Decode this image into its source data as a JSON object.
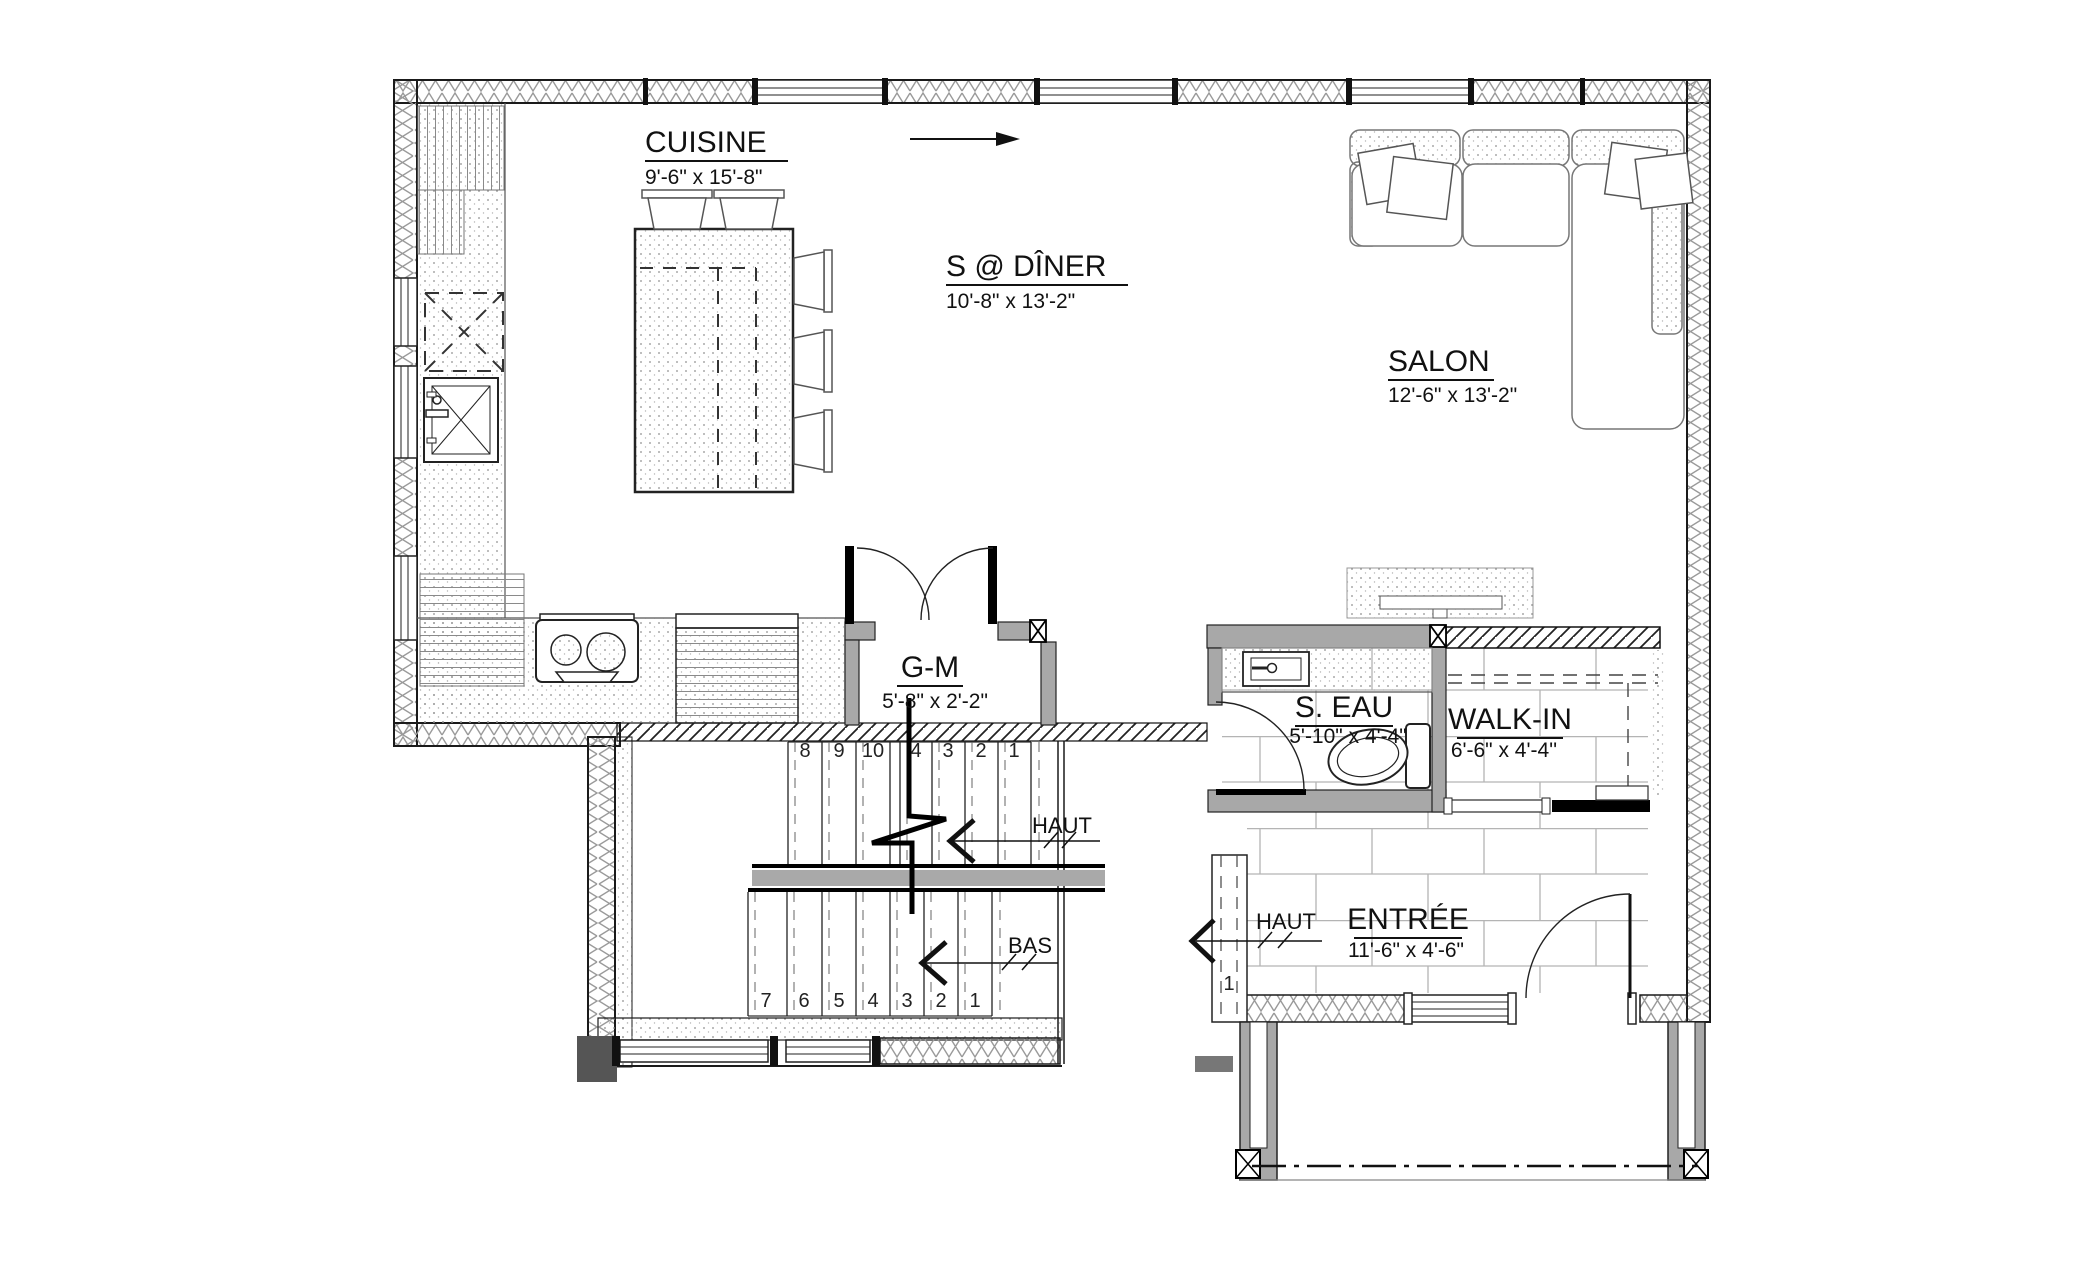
{
  "rooms": {
    "cuisine": {
      "name": "CUISINE",
      "dims": "9'-6\" x 15'-8\""
    },
    "salle_a_diner": {
      "name": "S @ DÎNER",
      "dims": "10'-8\" x 13'-2\""
    },
    "salon": {
      "name": "SALON",
      "dims": "12'-6\" x 13'-2\""
    },
    "garde_manger": {
      "name": "G-M",
      "dims": "5'-8\" x 2'-2\""
    },
    "salle_d_eau": {
      "name": "S. EAU",
      "dims": "5'-10\" x 4'-4\""
    },
    "walk_in": {
      "name": "WALK-IN",
      "dims": "6'-6\" x 4'-4''"
    },
    "entree": {
      "name": "ENTRÉE",
      "dims": "11'-6\" x 4'-6\""
    }
  },
  "stairs": {
    "up_label": "HAUT",
    "down_label": "BAS",
    "entry_up_label": "HAUT",
    "upper_flight_numbers": [
      "8",
      "9",
      "10",
      "4",
      "3",
      "2",
      "1"
    ],
    "lower_flight_numbers": [
      "7",
      "6",
      "5",
      "4",
      "3",
      "2",
      "1"
    ],
    "entry_step_number": "1"
  },
  "colors": {
    "wall_fill": "#a8a8a8",
    "landing_fill": "#a9a9a9",
    "line": "#1a1a1a",
    "paper": "#ffffff"
  }
}
